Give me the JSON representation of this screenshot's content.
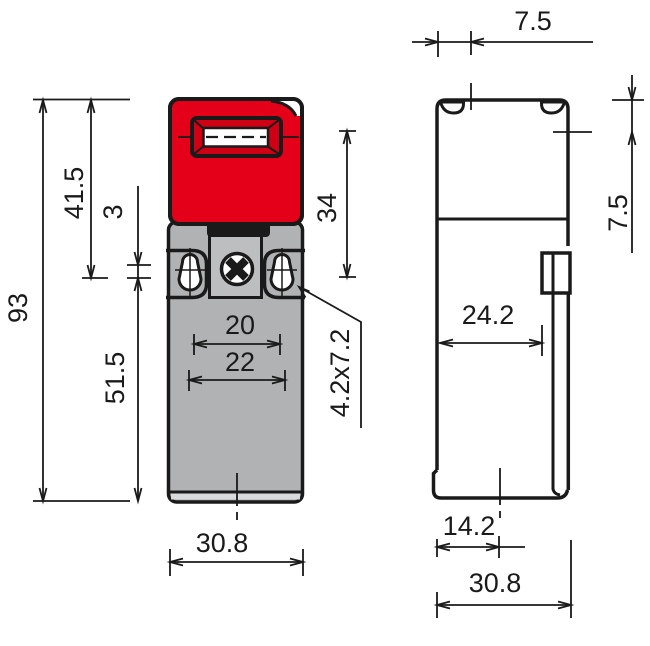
{
  "drawing": {
    "type": "technical-dimension-drawing",
    "subject": "safety-limit-switch",
    "views": [
      "front",
      "side"
    ]
  },
  "colors": {
    "head_red": "#e30018",
    "slot_red": "#cf0014",
    "body_gray": "#b0b2b4",
    "column_gray": "#bdbec0",
    "base_strip": "#d9dadb",
    "line": "#1a1a1a"
  },
  "front_view": {
    "dims": {
      "overall_height": "93",
      "top_to_hole": "41.5",
      "hole_offset": "3",
      "lower_height": "51.5",
      "slot_to_hole": "34",
      "mounting_hole_size": "4.2x7.2",
      "hole_pitch_inner": "20",
      "hole_pitch_outer": "22",
      "width": "30.8"
    }
  },
  "side_view": {
    "dims": {
      "top_offset": "7.5",
      "side_offset": "7.5",
      "cover_width": "24.2",
      "entry_offset": "14.2",
      "depth": "30.8"
    }
  }
}
